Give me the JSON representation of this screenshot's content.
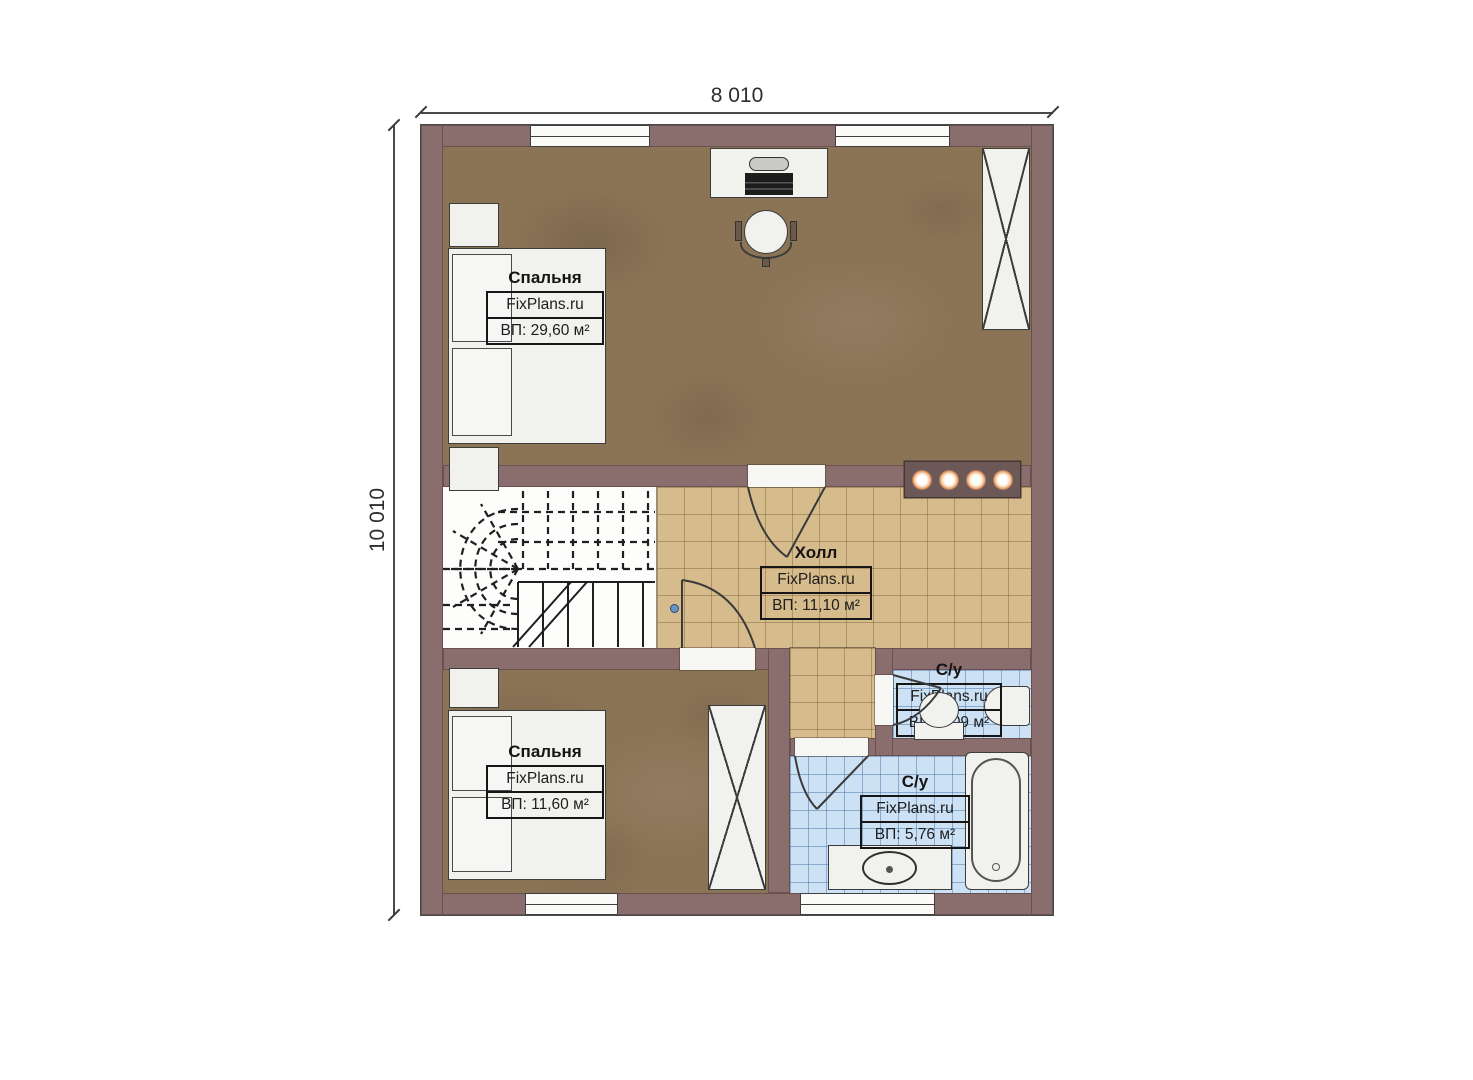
{
  "plan": {
    "type": "floor-plan",
    "dimensions": {
      "width": "8 010",
      "height": "10 010"
    },
    "rooms": {
      "bedroom_top": {
        "name": "Спальня",
        "brand": "FixPlans.ru",
        "area": "ВП: 29,60 м²"
      },
      "hall": {
        "name": "Холл",
        "brand": "FixPlans.ru",
        "area": "ВП: 11,10 м²"
      },
      "wc_small": {
        "name": "С/у",
        "brand": "FixPlans.ru",
        "area": "ВП: 2,09 м²"
      },
      "bathroom": {
        "name": "С/у",
        "brand": "FixPlans.ru",
        "area": "ВП: 5,76 м²"
      },
      "bedroom_bottom": {
        "name": "Спальня",
        "brand": "FixPlans.ru",
        "area": "ВП: 11,60 м²"
      }
    },
    "colors": {
      "wall": "#8a6d6d",
      "bedroom_floor": "#8b7355",
      "hall_tile": "#d6bb8d",
      "bath_tile": "#cde1f5",
      "fixture": "#f1f1ee",
      "accent_light": "#ec9c64",
      "handle_dot": "#6a93c8"
    }
  }
}
